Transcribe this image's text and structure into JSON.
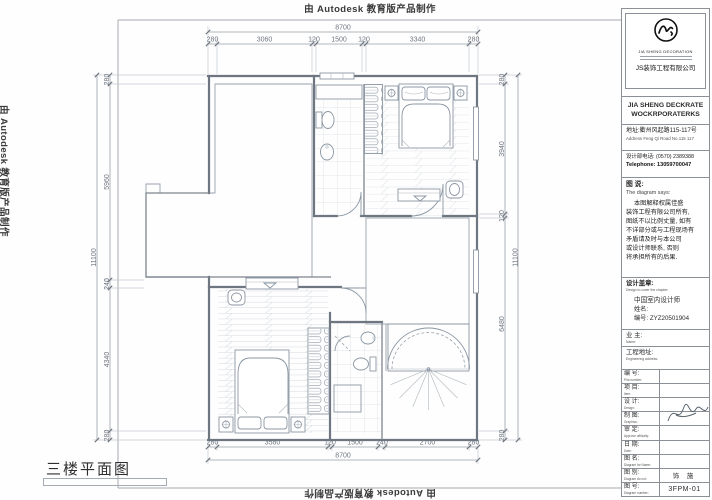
{
  "edge_stamp": "由 Autodesk 教育版产品制作",
  "plan": {
    "title": "三楼平面图",
    "dims": {
      "top_total": "8700",
      "top": [
        "280",
        "3060",
        "120",
        "1500",
        "120",
        "3340",
        "280"
      ],
      "bottom_total": "8700",
      "bottom": [
        "280",
        "3580",
        "120",
        "1500",
        "240",
        "2700",
        "280"
      ],
      "left_total": "11100",
      "left": [
        "280",
        "5960",
        "240",
        "4340",
        "280"
      ],
      "right_total": "11100",
      "right": [
        "280",
        "3940",
        "120",
        "6480",
        "280"
      ]
    }
  },
  "title_block": {
    "logo_brand": "JIA SHENG DECORATION",
    "company_cn": "JS装饰工程有限公司",
    "company_en_line1": "JIA SHENG DECKRATE",
    "company_en_line2": "WOCKRPORATERKS",
    "address_cn": "地址:衢州风起路115-117号",
    "address_en": "Address Feng Qi Road No.115 117",
    "phone_cn": "设计部电话: (0570) 2389388",
    "phone_en": "Telephone: 13059700047",
    "says_cn": "图 说:",
    "says_en": "The diagram says:",
    "disclaimer": [
      "本图解释权属佳盛",
      "装饰工程有限公司所有,",
      "图纸不以比例丈量, 如有",
      "不详部分或与工程现场有",
      "矛盾请及时与本公司",
      "或设计师联系, 否则",
      "将承担所有的后果."
    ],
    "seal_cn": "设计盖章:",
    "seal_en": "Design to cover the chapter:",
    "cert_line": "中国室内设计师",
    "name_label": "姓名:",
    "no_label": "编号: ZYZ20501904",
    "owner_cn": "业 主:",
    "owner_en": "Name:",
    "addr2_cn": "工程地址:",
    "addr2_en": "Engineering address:",
    "rows": [
      {
        "cn": "编 号:",
        "en": "Plot number:",
        "value": ""
      },
      {
        "cn": "项 目:",
        "en": "Item:",
        "value": ""
      },
      {
        "cn": "设 计:",
        "en": "Design:",
        "value": ""
      },
      {
        "cn": "制 图:",
        "en": "Graphics:",
        "value": ""
      },
      {
        "cn": "审 定:",
        "en": "Approve officially:",
        "value": ""
      },
      {
        "cn": "日 期:",
        "en": "Date:",
        "value": ""
      },
      {
        "cn": "图 名:",
        "en": "Diagram for Name:",
        "value": ""
      },
      {
        "cn": "图 别:",
        "en": "Diagram do not:",
        "value": "饰 施"
      },
      {
        "cn": "图 号:",
        "en": "Diagram number:",
        "value": "3FPM-01"
      }
    ]
  },
  "colors": {
    "wall": "#6e7681",
    "linework": "#8b97a3",
    "dim_text": "#6f7680",
    "stamp_text": "#3a3a3a"
  }
}
